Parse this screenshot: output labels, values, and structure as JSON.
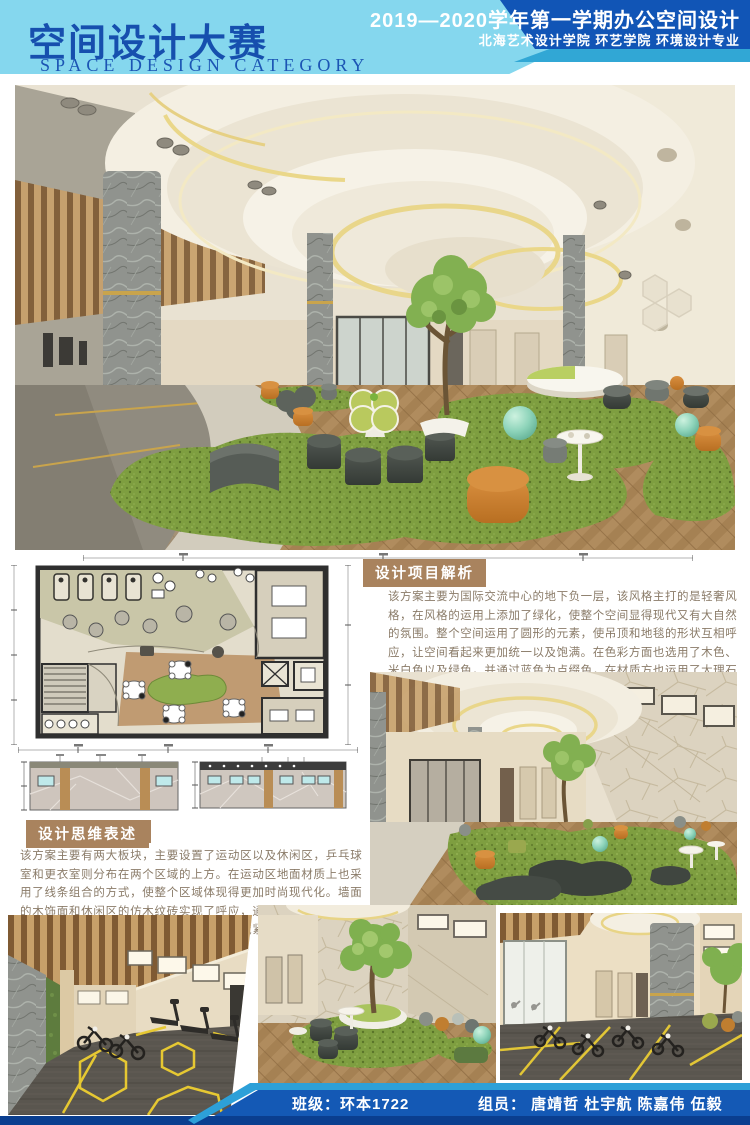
{
  "header": {
    "title": "空间设计大赛",
    "subtitle": "SPACE DESIGN CATEGORY",
    "course_title": "2019—2020学年第一学期办公空间设计",
    "institution": "北海艺术设计学院  环艺学院  环境设计专业"
  },
  "sections": {
    "project_analysis": {
      "heading": "设计项目解析",
      "body": "该方案主要为国际交流中心的地下负一层，该风格主打的是轻奢风格，在风格的运用上添加了绿化，使整个空间显得现代又有大自然的氛围。整个空间运用了圆形的元素，使吊顶和地毯的形状互相呼应，让空间看起来更加统一以及饱满。在色彩方面也选用了木色、米白色以及绿色，并通过蓝色为点缀色，在材质方也运用了大理石以及仿木纹砖，主动线把空间一分为二，使主动线和其他动线互不冲突和干扰。"
    },
    "design_thinking": {
      "heading": "设计思维表述",
      "body": "该方案主要有两大板块，主要设置了运动区以及休闲区，乒乓球室和更衣室则分布在两个区域的上方。在运动区地面材质上也采用了线条组合的方式，使整个区域体现得更加时尚现代化。墙面的木饰面和休闲区的仿木纹砖实现了呼应，通过材质来实现场景的切换。在简单利落的空间格局中，各场域紧密地串联合一，使整个风格统一干练。"
    }
  },
  "footer": {
    "class_label": "班级：环本1722",
    "members_label": "组员：  唐靖哲  杜宇航  陈嘉伟  伍毅"
  },
  "colors": {
    "header_light_blue": "#85d7ee",
    "header_dark_blue": "#1155b6",
    "header_teal_stripe": "#31a7d5",
    "title_blue": "#164fae",
    "section_heading_brown": "#a9835e",
    "body_text_brown": "#8a7b68",
    "footer_blue": "#1459b5",
    "footer_dark_blue": "#0a3e8f",
    "footer_cyan_stripe": "#2da0d8",
    "carpet_green": "#7e9e40",
    "accent_orange": "#c97c2e",
    "accent_mint": "#8ed4ba"
  }
}
